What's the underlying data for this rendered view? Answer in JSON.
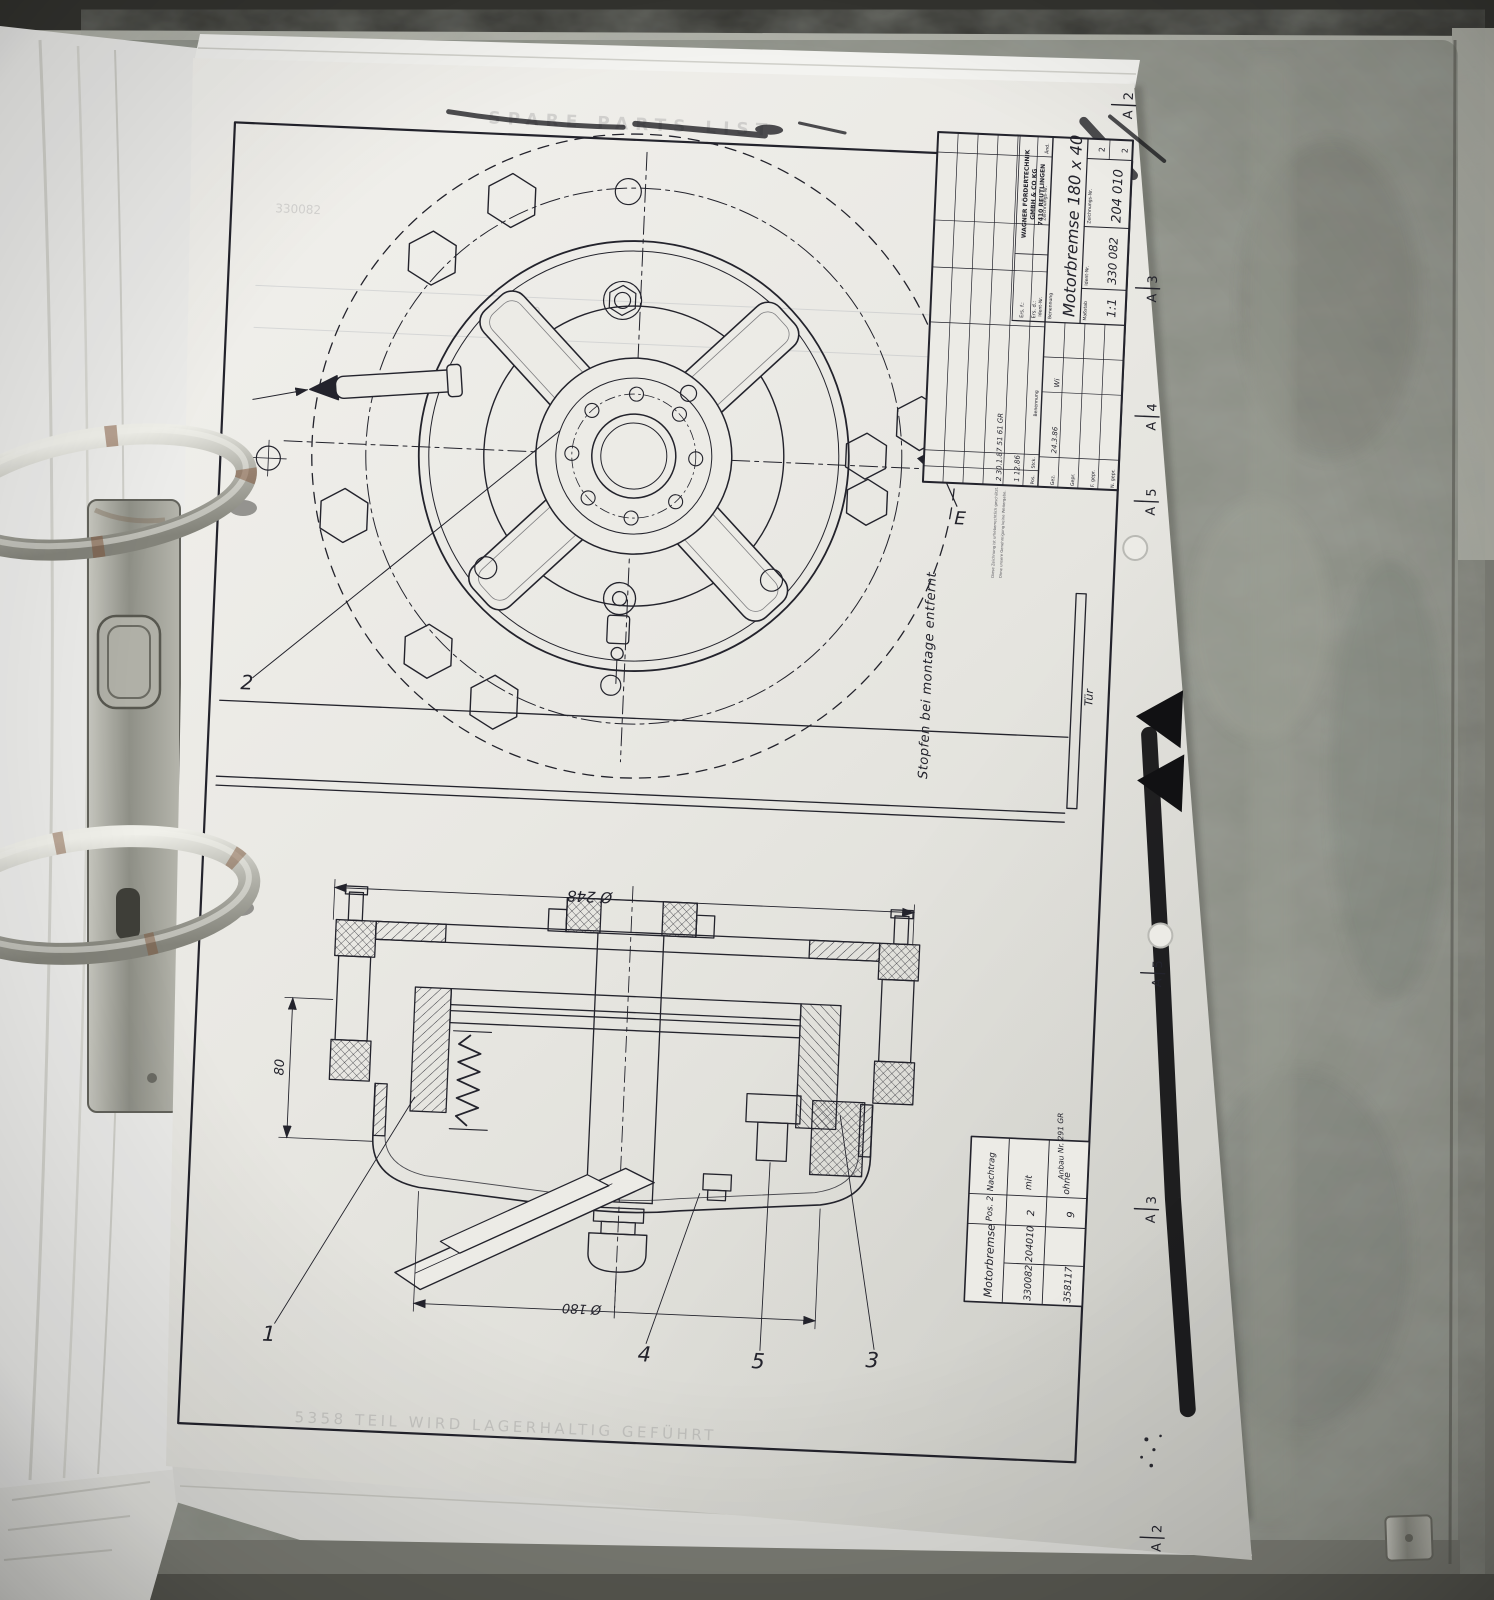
{
  "colors": {
    "paper": "#ecebe6",
    "ink": "#23232c",
    "binder": "#8c8f86",
    "desk": "#b4b5ac",
    "ring_metal": "#c6c6bf",
    "rust": "#7d5136"
  },
  "drawing": {
    "frame_markers": {
      "letter": "A",
      "positions": [
        "2",
        "3",
        "4",
        "5",
        "5",
        "3",
        "2"
      ]
    },
    "plan_view": {
      "callout": "2",
      "detail": "E",
      "note": "Stopfen bei montage entfernt",
      "door": "Tür"
    },
    "section_view": {
      "dim_outer": "Ø 248",
      "dim_inner": "Ø 180",
      "dim_height": "80",
      "c1": "1",
      "c4": "4",
      "c5": "5",
      "c3": "3"
    },
    "title_block": {
      "company1": "WAGNER FÖRDERTECHNIK",
      "company2": "GMBH & CO KG",
      "company3": "7410 REUTLINGEN",
      "ers_f": "Ers. f.:",
      "ers_d": "Ers. d.:",
      "label_pos": "Pos.",
      "label_stck": "Stck.",
      "label_benennung": "Benennung",
      "label_ident": "Ident-Nr.",
      "label_zng": "Zeichnungs-Nr.",
      "label_aend": "Änd.",
      "part_name": "Motorbremse  180 x 40",
      "label_masstab": "Maßstab",
      "scale": "1:1",
      "ident_no": "330 082",
      "drawing_no": "204 010",
      "sheet": "2",
      "sheets": "2",
      "label_gez": "Gez.",
      "label_gepr": "Gepr.",
      "label_fgepr": "F. gepr.",
      "label_ngepr": "N. gepr.",
      "date": "24.3.86",
      "signed": "Wi",
      "rev1": "2  30.1.87  51 61 GR",
      "rev2": "1   12.86",
      "legal1": "Diese Zeichnung ist urheberrechtlich geschützt.",
      "legal2": "Ohne unsere Genehmigung keine Weitergabe."
    },
    "stamp": {
      "name": "Motorbremse",
      "pos_header": "Pos. 2",
      "nachtrag_header": "Nachtrag",
      "id1": "330082",
      "id2": "204010",
      "qty1": "2",
      "with": "mit",
      "id3": "358117",
      "qty2": "9",
      "without": "ohne",
      "note": "Anbau Nr. 291 GR"
    },
    "show_through": {
      "header": "SPARE PARTS LIST",
      "part_no": "330082",
      "row": "253 010",
      "footer": "5358   TEIL WIRD LAGERHALTIG GEFÜHRT"
    }
  }
}
